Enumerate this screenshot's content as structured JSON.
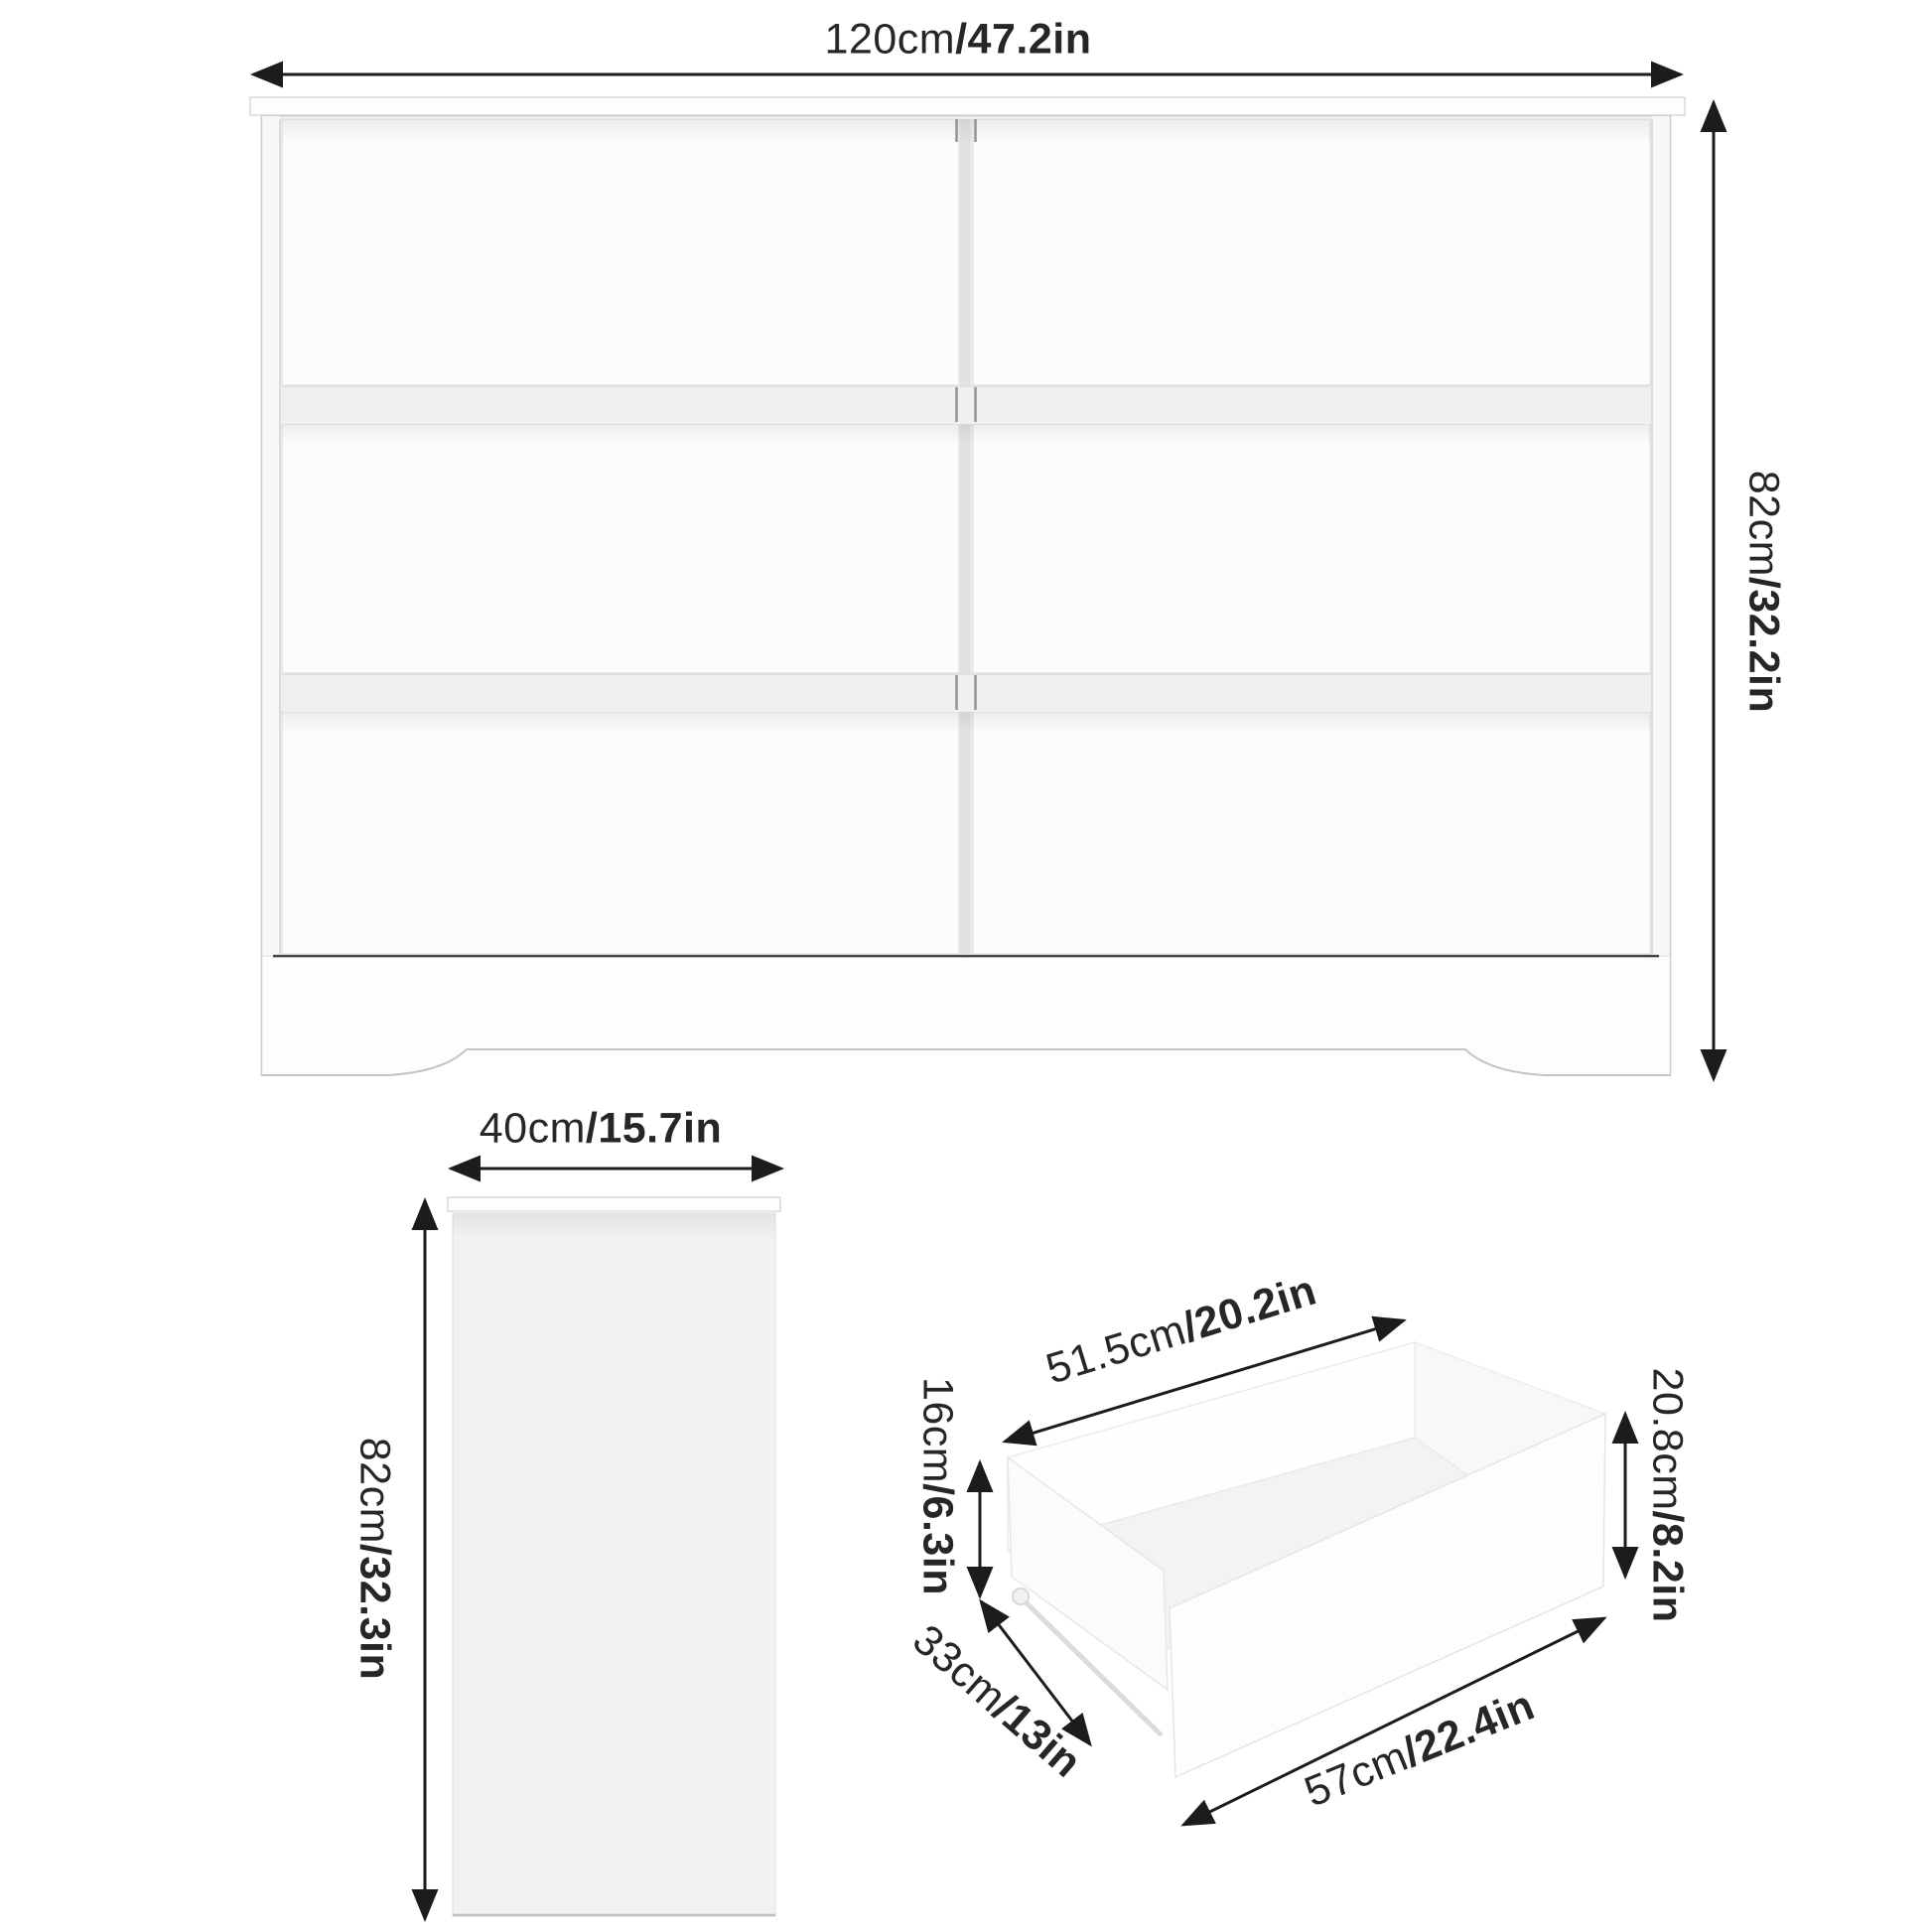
{
  "title": "6-drawer dresser dimension diagram",
  "colors": {
    "background": "#ffffff",
    "arrow": "#1c1c1c",
    "text": "#262626",
    "furniture_fill": "#fbfcfc",
    "furniture_shade": "#eef0f1",
    "side_panel_fill": "#f0f1f2",
    "edge_line": "#d6d8d9",
    "dark_base_line": "#454545"
  },
  "front_view": {
    "rows": 3,
    "columns": 2,
    "drawer_count": 6,
    "width": {
      "cm": "120cm",
      "in": "/47.2in"
    },
    "height": {
      "cm": "82cm",
      "in": "/32.2in"
    }
  },
  "side_view": {
    "width": {
      "cm": "40cm",
      "in": "/15.7in"
    },
    "height": {
      "cm": "82cm",
      "in": "/32.3in"
    }
  },
  "drawer_view": {
    "top_width": {
      "cm": "51.5cm",
      "in": "/20.2in"
    },
    "inner_height": {
      "cm": "16cm",
      "in": "/6.3in"
    },
    "depth": {
      "cm": "33cm",
      "in": "/13in"
    },
    "bottom_width": {
      "cm": "57cm",
      "in": "/22.4in"
    },
    "front_height": {
      "cm": "20.8cm",
      "in": "/8.2in"
    }
  }
}
